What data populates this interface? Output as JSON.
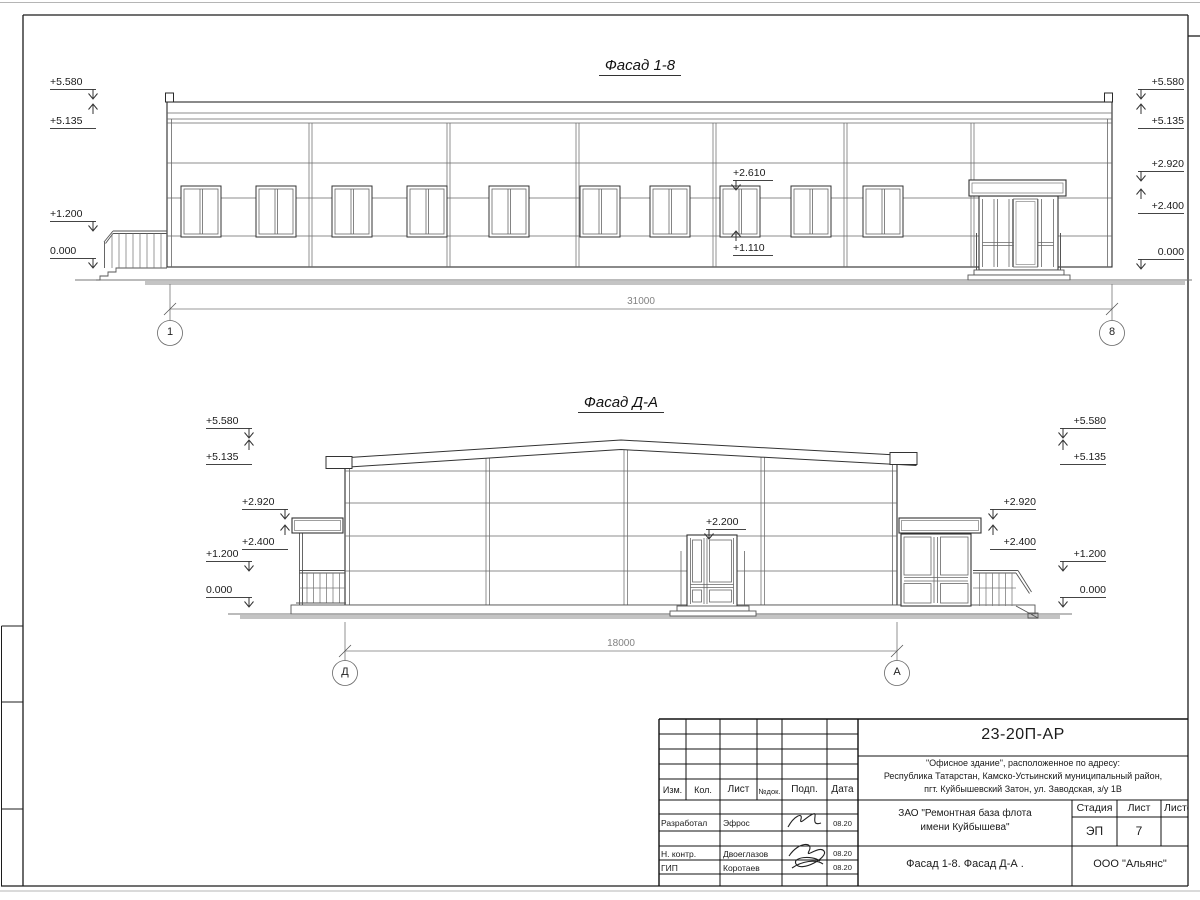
{
  "sheet": {
    "facade1": {
      "title": "Фасад 1-8",
      "dimension": "31000",
      "axis_left": "1",
      "axis_right": "8",
      "marks_left": [
        "+5.580",
        "+5.135",
        "+1.200",
        "0.000"
      ],
      "marks_right": [
        "+5.580",
        "+5.135",
        "+2.920",
        "+2.400",
        "0.000"
      ],
      "window_top_mark": "+2.610",
      "window_bottom_mark": "+1.110"
    },
    "facade2": {
      "title": "Фасад Д-А",
      "dimension": "18000",
      "axis_left": "Д",
      "axis_right": "А",
      "marks_left": [
        "+5.580",
        "+5.135",
        "+2.920",
        "+2.400",
        "+1.200",
        "0.000"
      ],
      "marks_right": [
        "+5.580",
        "+5.135",
        "+2.920",
        "+2.400",
        "+1.200",
        "0.000"
      ],
      "door_mark": "+2.200"
    },
    "titleblock": {
      "doc_number": "23-20П-АР",
      "address": [
        "\"Офисное здание\", расположенное по адресу:",
        "Республика Татарстан, Камско-Устьинский муниципальный район,",
        "пгт. Куйбышевский Затон, ул. Заводская, з/у 1В"
      ],
      "client": [
        "ЗАО \"Ремонтная база флота",
        "имени Куйбышева\""
      ],
      "stage_label": "Стадия",
      "sheet_label": "Лист",
      "sheets_label": "Листов",
      "stage_value": "ЭП",
      "sheet_value": "7",
      "sheet_title": "Фасад 1-8. Фасад Д-А .",
      "company": "ООО \"Альянс\"",
      "columns": [
        "Изм.",
        "Кол.",
        "Лист",
        "№док.",
        "Подп.",
        "Дата"
      ],
      "rows": [
        {
          "role": "Разработал",
          "name": "Эфрос",
          "date": "08.20"
        },
        {
          "role": "Н. контр.",
          "name": "Двоеглазов",
          "date": "08.20"
        },
        {
          "role": "ГИП",
          "name": "Коротаев",
          "date": "08.20"
        }
      ]
    }
  }
}
